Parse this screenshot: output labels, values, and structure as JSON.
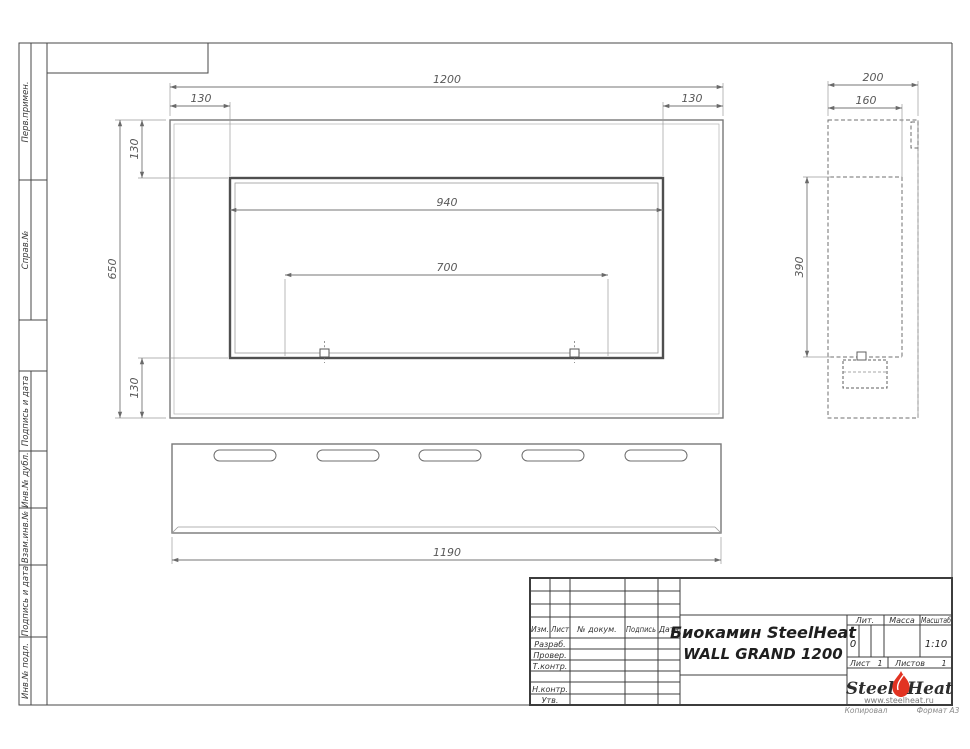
{
  "sidebar": {
    "labels": [
      "Перв.примен.",
      "Справ.№",
      "Подпись и дата",
      "Инв.№ дубл.",
      "Взам.инв.№",
      "Подпись и дата",
      "Инв.№ подл."
    ]
  },
  "dims": {
    "front": {
      "width": "1200",
      "margin_left": "130",
      "margin_right": "130",
      "height": "650",
      "top_offset": "130",
      "bottom_offset": "130",
      "opening_width": "940",
      "burner_span": "700"
    },
    "side": {
      "depth": "200",
      "inner_depth": "160",
      "opening_height": "390"
    },
    "bottom": {
      "length": "1190"
    }
  },
  "title_block": {
    "columns": {
      "izm": "Изм.",
      "list": "Лист",
      "doc": "№ докум.",
      "sign": "Подпись",
      "date": "Дата"
    },
    "roles": {
      "developed": "Разраб.",
      "checked": "Провер.",
      "tcontrol": "Т.контр.",
      "ncontrol": "Н.контр.",
      "approved": "Утв."
    },
    "title_line1": "Биокамин SteelHeat",
    "title_line2": "WALL GRAND 1200",
    "lit_label": "Лит.",
    "lit_value": "0",
    "mass_label": "Масса",
    "scale_label": "Масштаб",
    "scale_value": "1:10",
    "sheet_label": "Лист",
    "sheet_value": "1",
    "sheets_label": "Листов",
    "sheets_value": "1",
    "logo_steel": "Steel",
    "logo_heat": "Heat",
    "logo_site": "www.steelheat.ru",
    "footer_copy": "Копировал",
    "footer_format": "Формат А3",
    "flame_color": "#e23322"
  }
}
